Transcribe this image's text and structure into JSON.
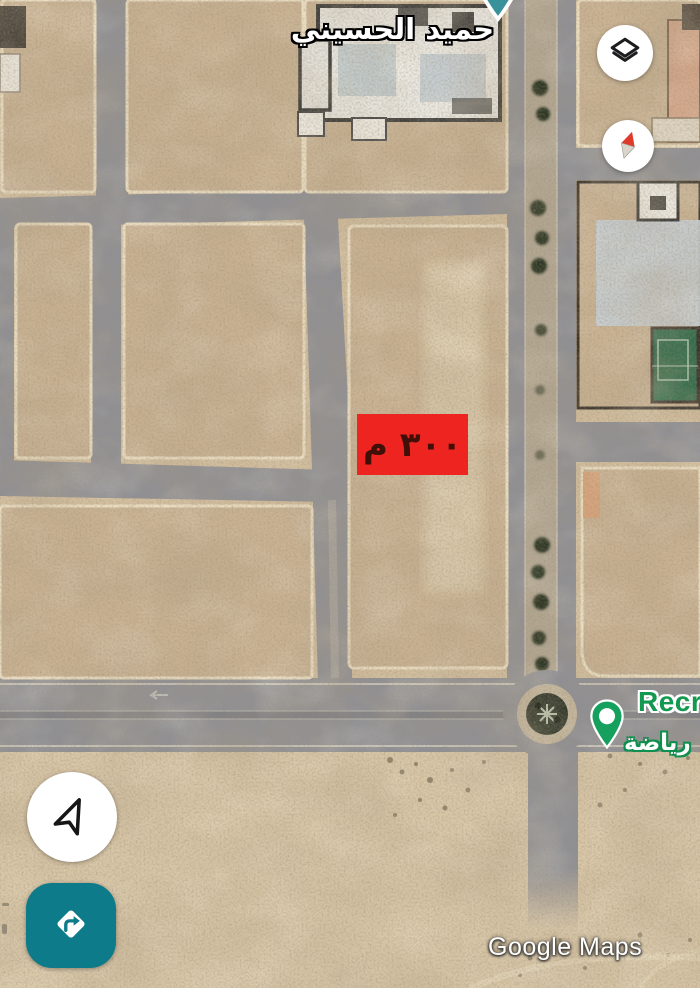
{
  "map": {
    "place_label": "حميد الحسيني",
    "measurement_label": "٣٠٠ م",
    "poi": {
      "label": "Recr",
      "label_arabic": "رياضة"
    },
    "watermark": "Google Maps"
  },
  "controls": {
    "layers": {
      "icon": "layers-icon"
    },
    "compass": {
      "icon": "compass-needle-icon"
    },
    "my_location": {
      "icon": "navigation-arrow-icon"
    },
    "directions": {
      "icon": "turn-right-arrow-icon"
    }
  },
  "colors": {
    "measurement_bg": "#ee2421",
    "measurement_text": "#401008",
    "poi_green": "#13994f",
    "marker_green": "#15a15d",
    "marker_teal": "#37929a",
    "directions_teal": "#0d7b8a",
    "road_gray": "#8f9096",
    "sand": "#d3bf9f",
    "field_green": "#2e6b4a"
  }
}
